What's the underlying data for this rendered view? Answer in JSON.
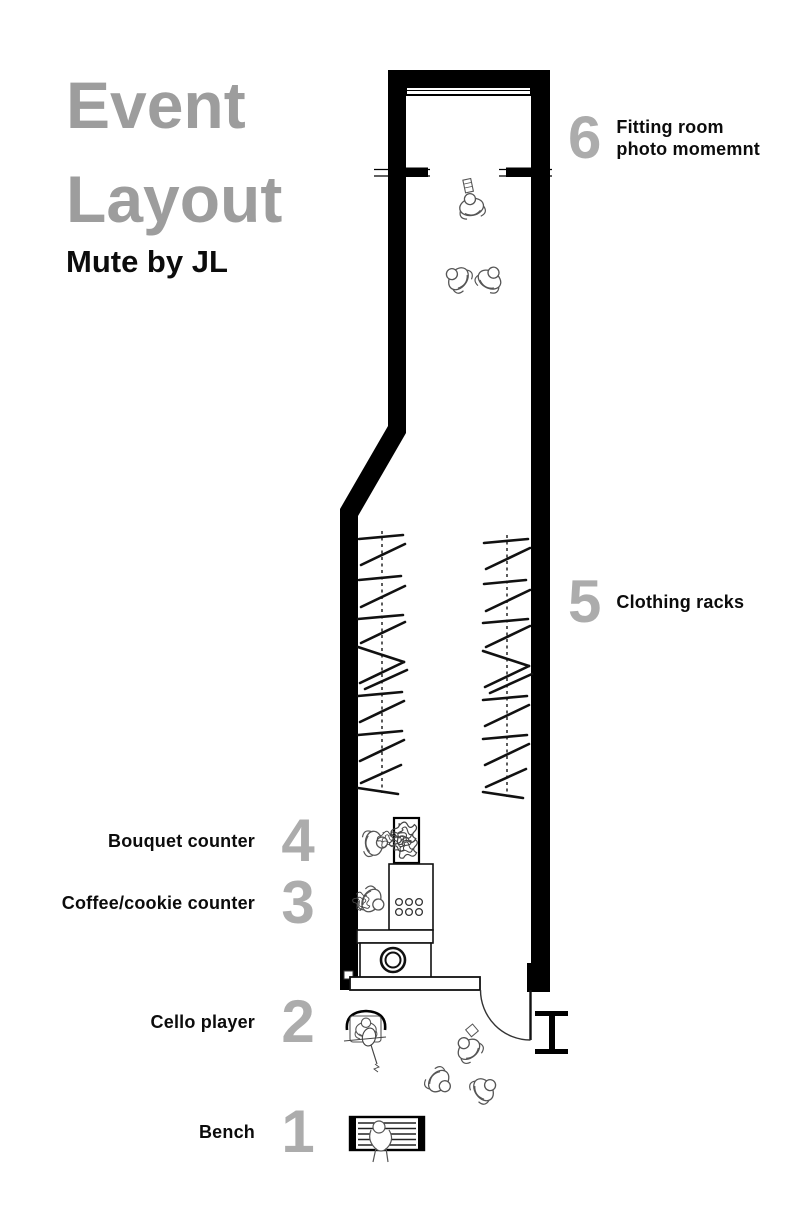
{
  "title": {
    "line1": "Event",
    "line2": "Layout"
  },
  "subtitle": "Mute by JL",
  "labels": {
    "left": [
      {
        "num": "4",
        "text": "Bouquet counter"
      },
      {
        "num": "3",
        "text": "Coffee/cookie counter"
      },
      {
        "num": "2",
        "text": "Cello player"
      },
      {
        "num": "1",
        "text": "Bench"
      }
    ],
    "right": [
      {
        "num": "6",
        "line1": "Fitting room",
        "line2": "photo momemnt"
      },
      {
        "num": "5",
        "text": "Clothing racks"
      }
    ]
  },
  "colors": {
    "title_gray": "#9d9d9d",
    "number_gray": "#acacac",
    "text_black": "#0c0c0c",
    "wall_black": "#000000",
    "figure_line_gray": "#555555"
  },
  "plan": {
    "name": "store-floor-plan",
    "items": [
      "outer-walls",
      "photo-backdrop-rail",
      "fitting-room-partition",
      "clothing-rack-left",
      "clothing-rack-right",
      "bouquet-display",
      "coffee-counter",
      "service-counter",
      "entry-platform",
      "entry-door",
      "steel-column",
      "bench",
      "cello-player",
      "visitor-figures"
    ]
  }
}
